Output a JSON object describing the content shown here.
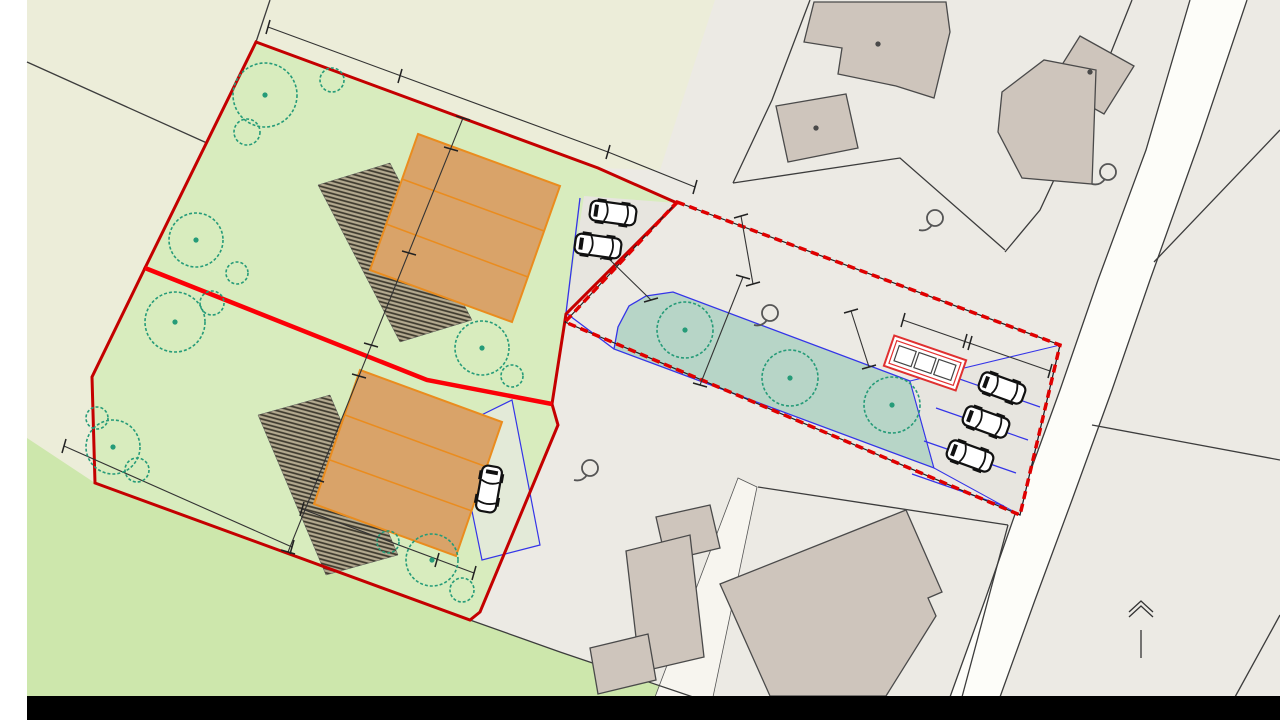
{
  "branding": {
    "logo_re": "RE",
    "logo_slash": "/",
    "logo_max": "MAX"
  },
  "footer": {
    "title": "ÚZEMNÍ STUDIE"
  },
  "street": {
    "name": "Vlečná"
  },
  "north_arrow": {
    "label": "S"
  },
  "parcels": {
    "p6073_2": "6073/2",
    "p6069": "6069",
    "p6064_3": "6064/3",
    "p6064_1": "6064/1",
    "p6064_2": "6064/2",
    "p6058": "6058",
    "p6063_1": "6063/1",
    "p6063_2": "6063/2",
    "p6062_1": "6062/1",
    "p6062_2": "6062/2",
    "p6068": "6068",
    "p6066": "6066",
    "p6067_1": "6067/1",
    "p6067_2": "6067/2",
    "p6067_3": "6067/3",
    "p6118_1": "6118/1",
    "p6080": "6080",
    "p6061": "6061"
  },
  "building_numbers": {
    "b915": "915",
    "b1053": "1053",
    "b1792": "1792"
  },
  "areas": {
    "a6064_3": "801,38 m²",
    "a6064_1": "806,59 m²",
    "house_a": "150,00 m²",
    "house_b": "150,00 m²",
    "drive_a": "60,70 m²",
    "drive_b": "86,90 m²",
    "common": "203,00 m²",
    "garden": "301,24 m²"
  },
  "dimensions": {
    "d16": "16",
    "d15_top": "15",
    "d9_top": "9",
    "d3_a": "3",
    "d10_a": "10",
    "d9_a": "9",
    "d3_b": "3",
    "d10_b": "10",
    "d7": "7",
    "d20": "20",
    "d15_s": "15",
    "d4_s": "4",
    "d4_tri": "4",
    "d4_r": "4",
    "d11": "11",
    "d3_r": "3",
    "d6_1": "6",
    "d6_2": "6"
  },
  "colors": {
    "brand_red": "#e01b2f",
    "brand_blue": "#1c49a8",
    "boundary_red": "#c40000",
    "divider_red": "#fb0007",
    "proposal_dash_red": "#e00000",
    "utility_blue": "#3434e8",
    "parcel_green": "#d8ecbe",
    "meadow_green": "#cde7ac",
    "garden_teal": "#b7d5c7",
    "house_orange": "#d9a369",
    "base_beige": "#ecedd9"
  }
}
